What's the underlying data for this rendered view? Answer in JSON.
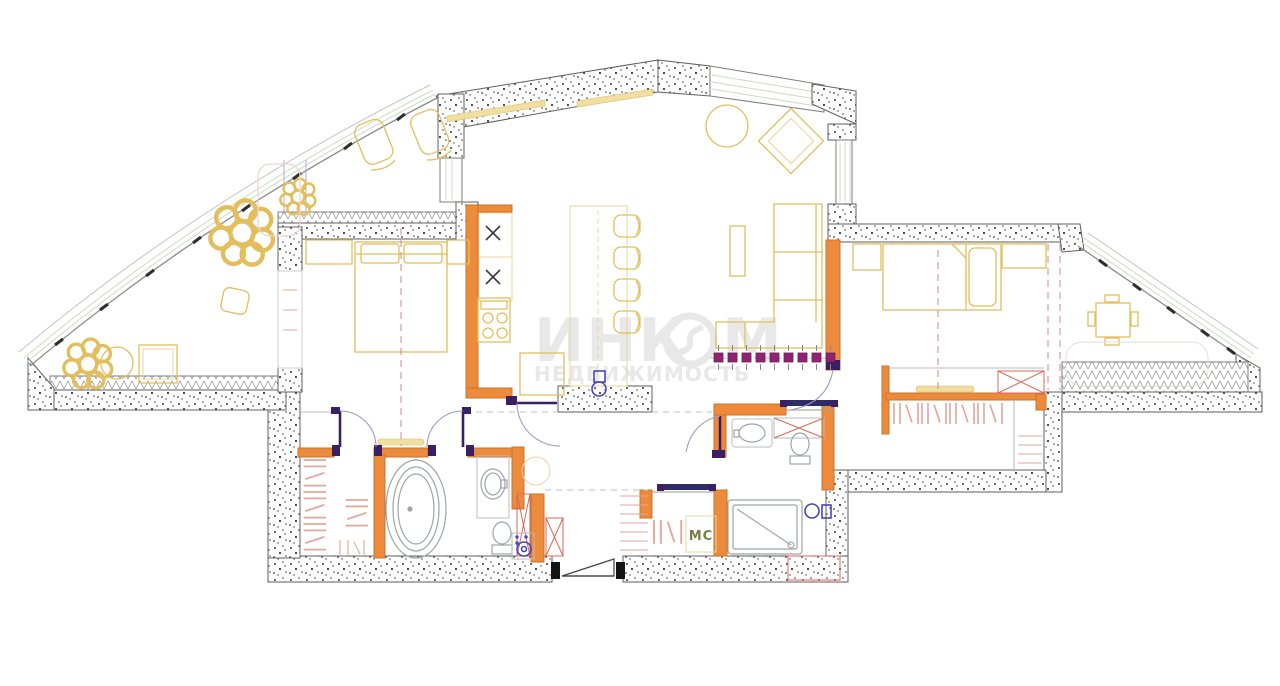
{
  "watermark": {
    "brand": "ИНКОМ",
    "brand_part1": "ИНК",
    "brand_part2": "М",
    "subtitle": "НЕДВИЖИМОСТЬ"
  },
  "labels": {
    "utility_room": "МС"
  },
  "colors": {
    "background": "#FFFFFF",
    "wall_orange": "#ED8B3D",
    "wall_orange_edge": "#C8742B",
    "door_purple": "#3A2063",
    "door_arc": "#9B9BC4",
    "partition_magenta": "#8E2470",
    "furniture_yellow": "#E2BE5C",
    "fixture_gray": "#9FA5A5",
    "plumbing_blue": "#4547BE",
    "closet_rose": "#E2A79A",
    "panel_red": "#D9685A",
    "centerline_red": "#D08A8A",
    "glazing_green": "#CBDCC0",
    "line_gray": "#5F5F5F",
    "watermark_gray": "#E7E7E7",
    "label_olive": "#7C7C45"
  },
  "symbols": [
    "bathtub",
    "shower-tray",
    "toilet",
    "sink",
    "washing-machine",
    "cooktop",
    "kitchen-sink",
    "bar-counter",
    "bed",
    "sofa",
    "dining-table",
    "plant",
    "accordion-partition",
    "entrance-door",
    "wardrobe-hangers",
    "lounge-chair",
    "glazing",
    "radiator"
  ]
}
